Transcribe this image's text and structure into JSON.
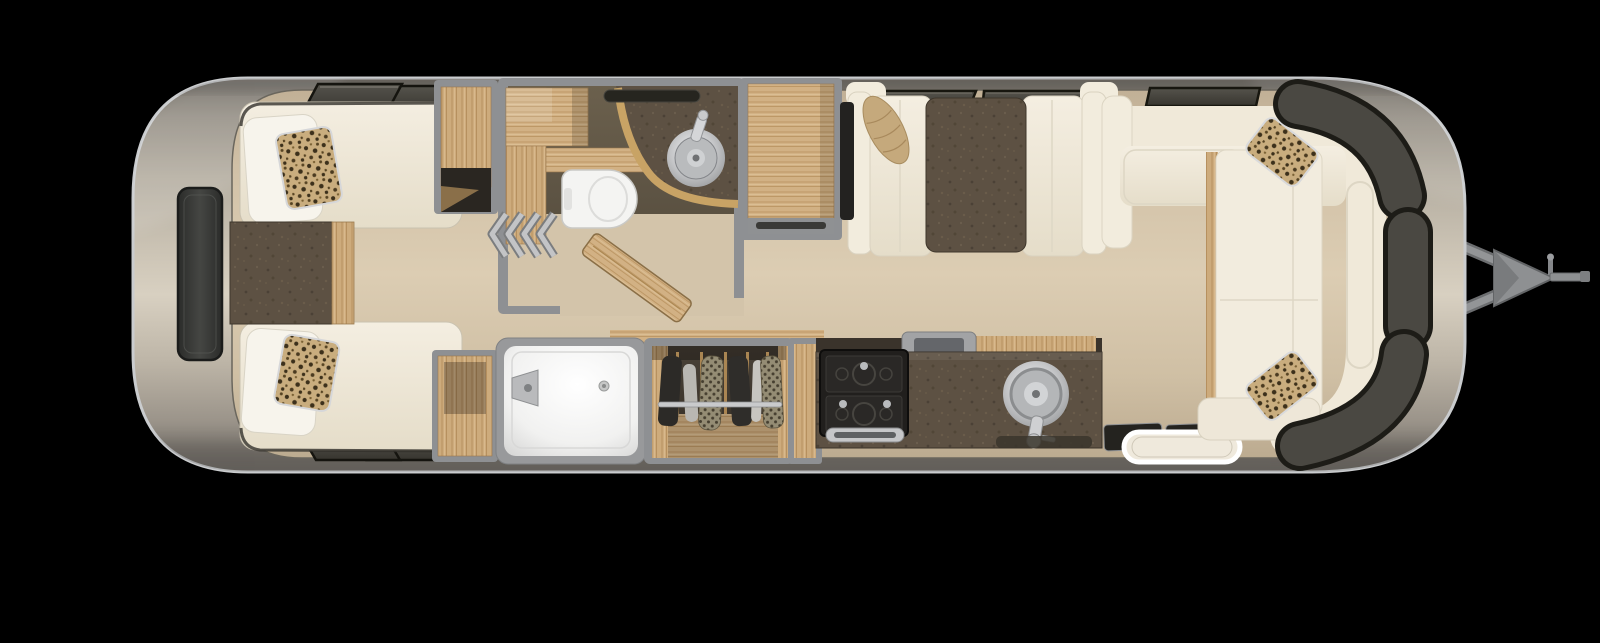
{
  "scene": {
    "type": "floorplan-top-down-render",
    "subject": "travel trailer interior floor plan",
    "background": "black",
    "rear_side": "left",
    "hitch_side": "right"
  },
  "palette": {
    "background": "#000000",
    "body_metal_light": "#d8d0c1",
    "body_metal_dark": "#6f6b64",
    "body_rim": "#caccce",
    "floor": "#d3c4aa",
    "wall": "#8e9093",
    "cream": "#f2ecdd",
    "cream2": "#e9e2d1",
    "white": "#f4f4f2",
    "silver": "#c7c8ca",
    "steel": "#8e9092",
    "wood_light": "#d2b184",
    "wood_mid": "#b8925f",
    "counter_brown": "#5d5143",
    "bath_floor": "#5c5243",
    "charcoal_window": "#46443f",
    "window_frame": "#1d1c17",
    "black_fixture": "#1d1c1a",
    "leopard_tan": "#c9ad7e",
    "leopard_spot": "#3c301b",
    "clothes_dark": "#2c2a27",
    "clothes_knit": "#948c74",
    "mat_dark": "#24231f",
    "tv_panel": "#3a3b39"
  },
  "rooms": [
    {
      "name": "rear-bedroom",
      "features": [
        "twin-bed-upper",
        "twin-bed-lower",
        "white-pillows",
        "leopard-accent-pillows",
        "nightstand",
        "rear-wall-tv",
        "slanted-windows-top",
        "slanted-windows-bottom"
      ]
    },
    {
      "name": "bathroom",
      "features": [
        "toilet",
        "vanity-counter",
        "round-vessel-sink",
        "faucet",
        "wood-cabinets",
        "roof-vent",
        "accordion-door",
        "open-wood-door"
      ]
    },
    {
      "name": "hall-storage",
      "features": [
        "wood-dresser",
        "tall-wardrobe-cabinet"
      ]
    },
    {
      "name": "shower-room",
      "features": [
        "walk-in-shower",
        "shower-fixture",
        "drain"
      ]
    },
    {
      "name": "hanging-closet",
      "features": [
        "closet-rod",
        "hanging-clothes",
        "wood-hangers",
        "wood-floor"
      ]
    },
    {
      "name": "galley-kitchen",
      "features": [
        "two-burner-cooktop",
        "oven-handle",
        "flush-griddle-cover",
        "wood-slat-counter",
        "round-stainless-sink",
        "faucet",
        "dark-countertop",
        "floor-mat"
      ]
    },
    {
      "name": "dinette",
      "features": [
        "facing-bench-seats",
        "dinette-table",
        "bolster-pillow",
        "side-tv-panel",
        "two-awning-windows"
      ]
    },
    {
      "name": "front-lounge",
      "features": [
        "wraparound-sofa",
        "chaise-bench",
        "leopard-pillow-top",
        "leopard-pillow-bottom",
        "panoramic-front-windows",
        "window-above-sofa"
      ]
    },
    {
      "name": "entryway",
      "features": [
        "entry-mats",
        "lighted-entry-step"
      ]
    },
    {
      "name": "exterior",
      "features": [
        "aluminum-body-shell",
        "a-frame-tongue",
        "hitch-coupler",
        "tongue-jack"
      ]
    }
  ]
}
